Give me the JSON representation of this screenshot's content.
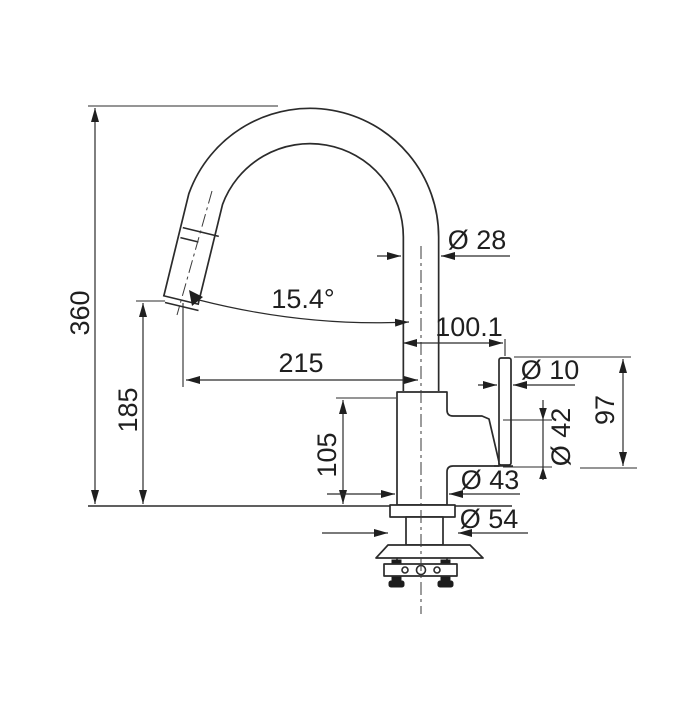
{
  "drawing": {
    "title": "kitchen-faucet-dimension-drawing",
    "background_color": "#ffffff",
    "line_color": "#2b2b2b",
    "dimensions": {
      "total_height": "360",
      "outlet_height": "185",
      "spout_reach": "215",
      "spout_angle": "15.4°",
      "spout_tube_diameter": "Ø 28",
      "lever_offset": "100.1",
      "lever_diameter": "Ø 10",
      "lever_assembly_height": "97",
      "cartridge_diameter": "Ø 42",
      "body_diameter": "Ø 43",
      "body_height": "105",
      "base_diameter": "Ø 54"
    }
  }
}
